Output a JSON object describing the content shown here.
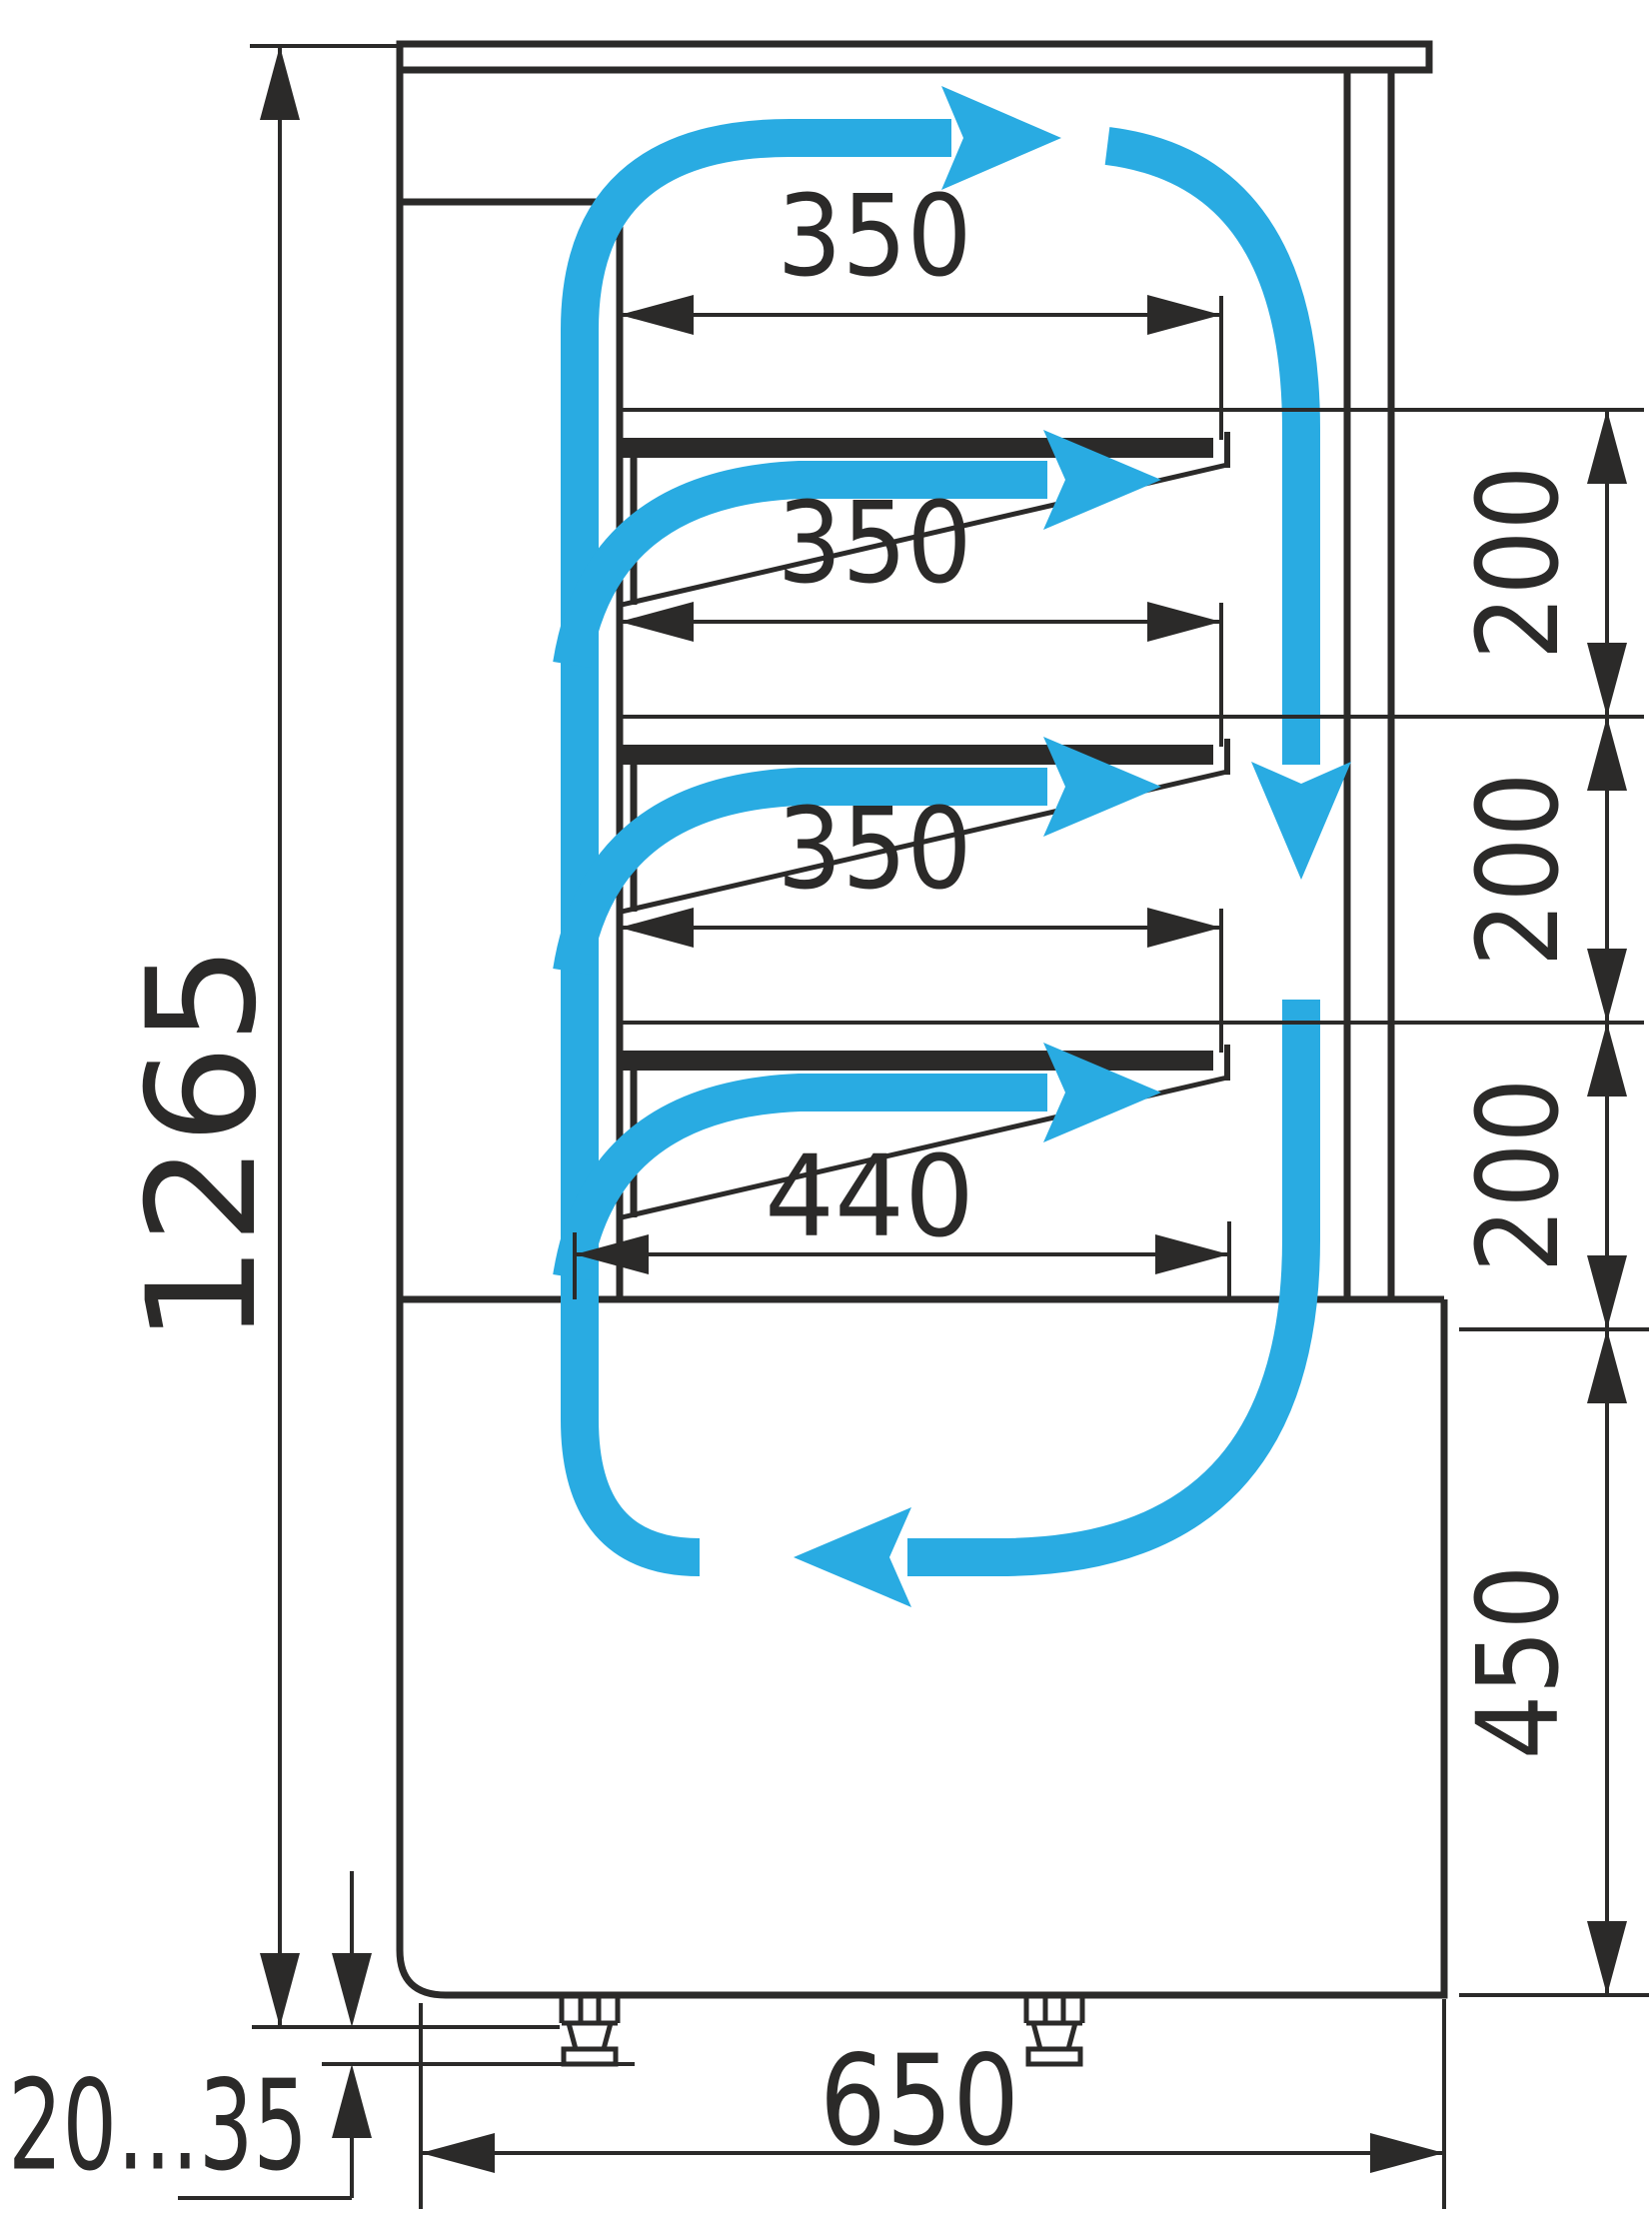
{
  "drawing": {
    "type": "refrigerated-display-case-side-section-airflow-diagram",
    "colors": {
      "line": "#2B2A29",
      "airflow": "#29ABE2",
      "background": "#FFFFFF"
    },
    "dimensions": {
      "overall_height": "1265",
      "shelf_width_1": "350",
      "shelf_width_2": "350",
      "shelf_width_3": "350",
      "bottom_shelf_width": "440",
      "shelf_gap_1": "200",
      "shelf_gap_2": "200",
      "shelf_gap_3": "200",
      "base_height": "450",
      "overall_depth": "650",
      "feet_height_range": "20...35"
    }
  }
}
